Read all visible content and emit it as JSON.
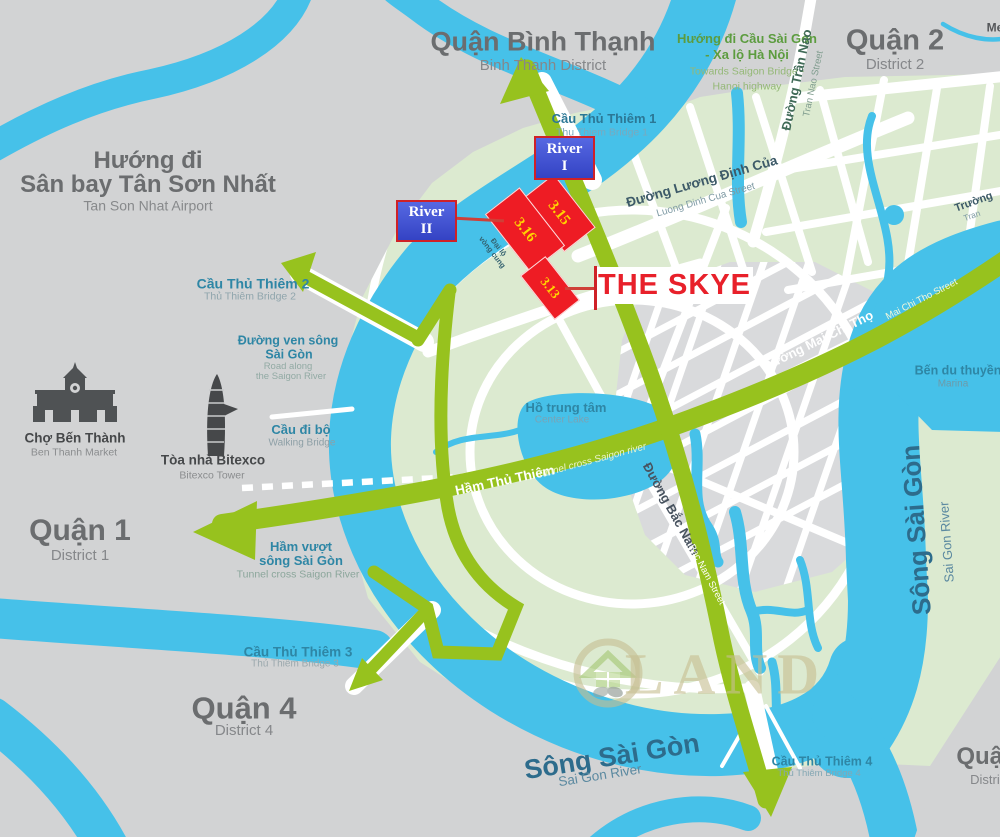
{
  "title": "Thu Thiem / The Skye location map",
  "colors": {
    "water": "#46c1e9",
    "land_green": "#dcead0",
    "land_gray": "#d2d3d4",
    "zone_gray": "#d9dadc",
    "road_green": "#97c21e",
    "red": "#ee1c24",
    "block_text": "#ffd400",
    "river_box_blue": "#4355d6",
    "label_teal": "#2e86a5",
    "river_text": "#2d6c8c"
  },
  "districts": {
    "binh_thanh": {
      "vi": "Quận Bình Thạnh",
      "en": "Binh Thanh District"
    },
    "district2": {
      "vi": "Quận 2",
      "en": "District 2"
    },
    "district1": {
      "vi": "Quận 1",
      "en": "District 1"
    },
    "district4": {
      "vi": "Quận 4",
      "en": "District 4"
    },
    "district_edge": {
      "vi": "Quận",
      "en": "District"
    }
  },
  "directions": {
    "airport": {
      "vi1": "Hướng đi",
      "vi2": "Sân bay Tân Sơn Nhất",
      "en": "Tan Son Nhat Airport"
    },
    "saigon_bridge": {
      "vi1": "Hướng đi Cầu Sài Gòn",
      "vi2": "- Xa lộ Hà Nội",
      "en1": "Towards Saigon Bridge -",
      "en2": "Hanoi highway"
    }
  },
  "bridges": {
    "tt1": {
      "vi": "Cầu Thủ Thiêm 1",
      "en": "Thu Thiem Bridge 1"
    },
    "tt2": {
      "vi": "Cầu Thủ Thiêm 2",
      "en": "Thủ Thiêm Bridge 2"
    },
    "tt3": {
      "vi": "Cầu Thủ Thiêm 3",
      "en": "Thủ Thiêm Bridge 3"
    },
    "tt4": {
      "vi": "Cầu Thủ Thiêm 4",
      "en": "Thủ Thiêm Bridge 4"
    },
    "walking": {
      "vi": "Cầu đi bộ",
      "en": "Walking Bridge"
    }
  },
  "roads": {
    "tran_nao": {
      "vi": "Đường Trần Nao",
      "en": "Tran Nao Street"
    },
    "luong_dinh_cua": {
      "vi": "Đường Lương Định Của",
      "en": "Luong Dinh Cua Street"
    },
    "mai_chi_tho": {
      "vi": "Đường Mai Chí Thọ",
      "en": "Mai Chi Tho Street"
    },
    "bac_nam": {
      "vi": "Đường Bắc Nam",
      "en": "Bac Nam Street"
    },
    "ven_song": {
      "vi1": "Đường ven sông",
      "vi2": "Sài Gòn",
      "en1": "Road along",
      "en2": "the Saigon River"
    },
    "ham_thu_thiem": {
      "vi": "Hầm Thủ Thiêm",
      "en": "Tunnel cross Saigon river"
    },
    "ham_vuot": {
      "vi1": "Hầm vượt",
      "vi2": "sông Sài Gòn",
      "en": "Tunnel cross Saigon River"
    },
    "dai_lo": {
      "vi1": "Đại lộ",
      "vi2": "vòng cung"
    }
  },
  "water": {
    "song_sai_gon_south": {
      "vi": "Sông Sài Gòn",
      "en": "Sai Gon River"
    },
    "song_sai_gon_east": {
      "vi": "Sông Sài Gòn",
      "en": "Sai Gon River"
    },
    "center_lake": {
      "vi": "Hồ trung tâm",
      "en": "Center Lake"
    },
    "me_stream": "Me"
  },
  "landmarks": {
    "ben_thanh": {
      "vi": "Chợ Bến Thành",
      "en": "Ben Thanh Market"
    },
    "bitexco": {
      "vi": "Tòa nhà Bitexco",
      "en": "Bitexco Tower"
    },
    "marina": {
      "vi": "Bến du thuyền",
      "en": "Marina"
    },
    "school_edge": {
      "vi": "Trường",
      "en": "Tran"
    }
  },
  "project": {
    "name": "THE SKYE",
    "river1": {
      "line1": "River",
      "line2": "I"
    },
    "river2": {
      "line1": "River",
      "line2": "II"
    },
    "blocks": [
      "3.15",
      "3.16",
      "3.13"
    ]
  },
  "watermark": {
    "text": "LAND"
  }
}
